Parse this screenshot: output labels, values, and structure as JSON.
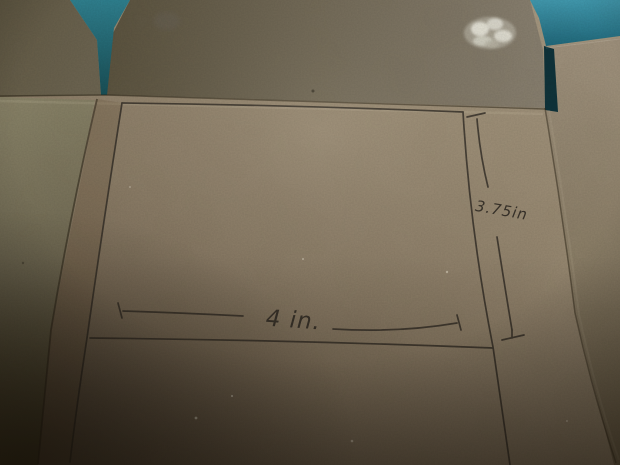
{
  "photo": {
    "type": "photograph",
    "subject": "Flattened cardboard box panel with a hand-drawn pencil cutting template and dimension lines",
    "pencil_sketch": {
      "shape": "rectangle outline with dimension lines",
      "width_label": "4 in.",
      "height_label": "3.75in"
    },
    "colors": {
      "background_teal_bright": "#429cb2",
      "background_teal_dark": "#1d5a66",
      "gap_shadow": "#0d333b",
      "cardboard_main": "#8d7e68",
      "cardboard_light": "#a89a82",
      "cardboard_dark": "#564a36",
      "top_flap": "#766d5a",
      "left_flap": "#7d7660",
      "right_flap": "#92846d",
      "pencil": "#38322a",
      "paint_patch": "#e9e7db"
    }
  }
}
